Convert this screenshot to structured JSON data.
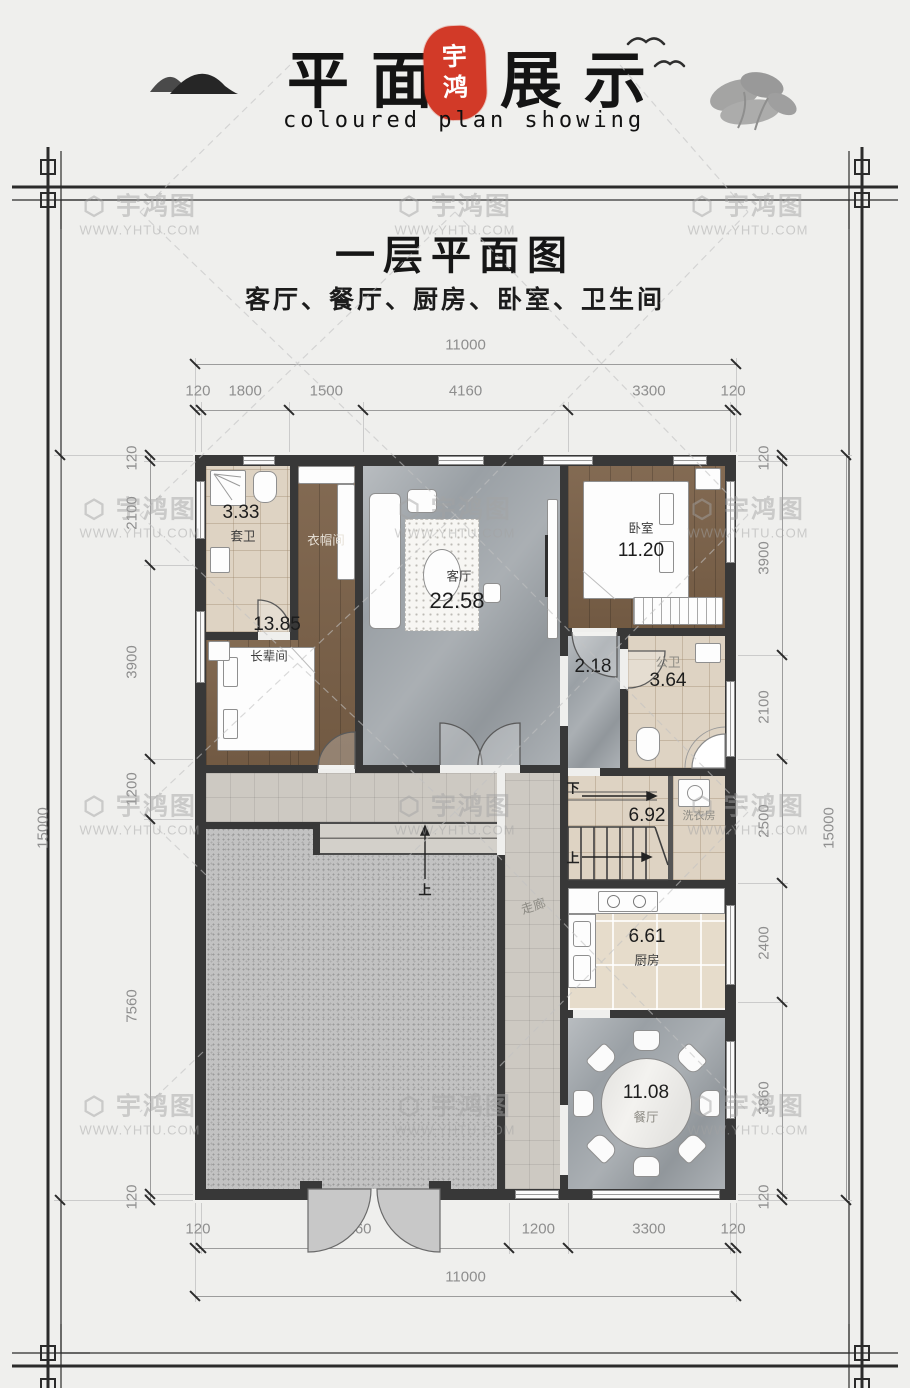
{
  "header": {
    "title_part1": "平面",
    "title_part2": "展示",
    "seal_line1": "宇",
    "seal_line2": "鸿",
    "subtitle": "coloured plan showing",
    "seal_color": "#d23a28"
  },
  "plan_title": {
    "main": "一层平面图",
    "sub": "客厅、餐厅、厨房、卧室、卫生间"
  },
  "watermark": {
    "logo": "⬡",
    "brand": "宇鸿图",
    "url": "WWW.YHTU.COM"
  },
  "dimensions": {
    "top": {
      "total": "11000",
      "segments": [
        "120",
        "1800",
        "1500",
        "4160",
        "3300",
        "120"
      ]
    },
    "bottom": {
      "total": "11000",
      "segments": [
        "120",
        "6260",
        "1200",
        "3300",
        "120"
      ]
    },
    "left": {
      "total": "15000",
      "segments": [
        "120",
        "2100",
        "3900",
        "1200",
        "7560",
        "120"
      ]
    },
    "right": {
      "total": "15000",
      "segments": [
        "120",
        "3900",
        "2100",
        "2500",
        "2400",
        "3860",
        "120"
      ]
    }
  },
  "rooms": {
    "bath1": {
      "area": "3.33",
      "name": "套卫"
    },
    "closet": {
      "name": "衣帽间"
    },
    "living": {
      "name": "客厅",
      "area": "22.58"
    },
    "bedroom": {
      "name": "卧室",
      "area": "11.20"
    },
    "elder": {
      "area": "13.85",
      "name": "长辈间"
    },
    "hall": {
      "area": "2.18"
    },
    "bath2": {
      "name": "公卫",
      "area": "3.64"
    },
    "stairwell": {
      "area": "6.92"
    },
    "laundry": {
      "name": "洗衣房"
    },
    "corridor": {
      "name": "走廊"
    },
    "kitchen": {
      "area": "6.61",
      "name": "厨房"
    },
    "dining": {
      "area": "11.08",
      "name": "餐厅"
    }
  },
  "stairs": {
    "up": "上",
    "down": "下",
    "entry_up": "上"
  }
}
